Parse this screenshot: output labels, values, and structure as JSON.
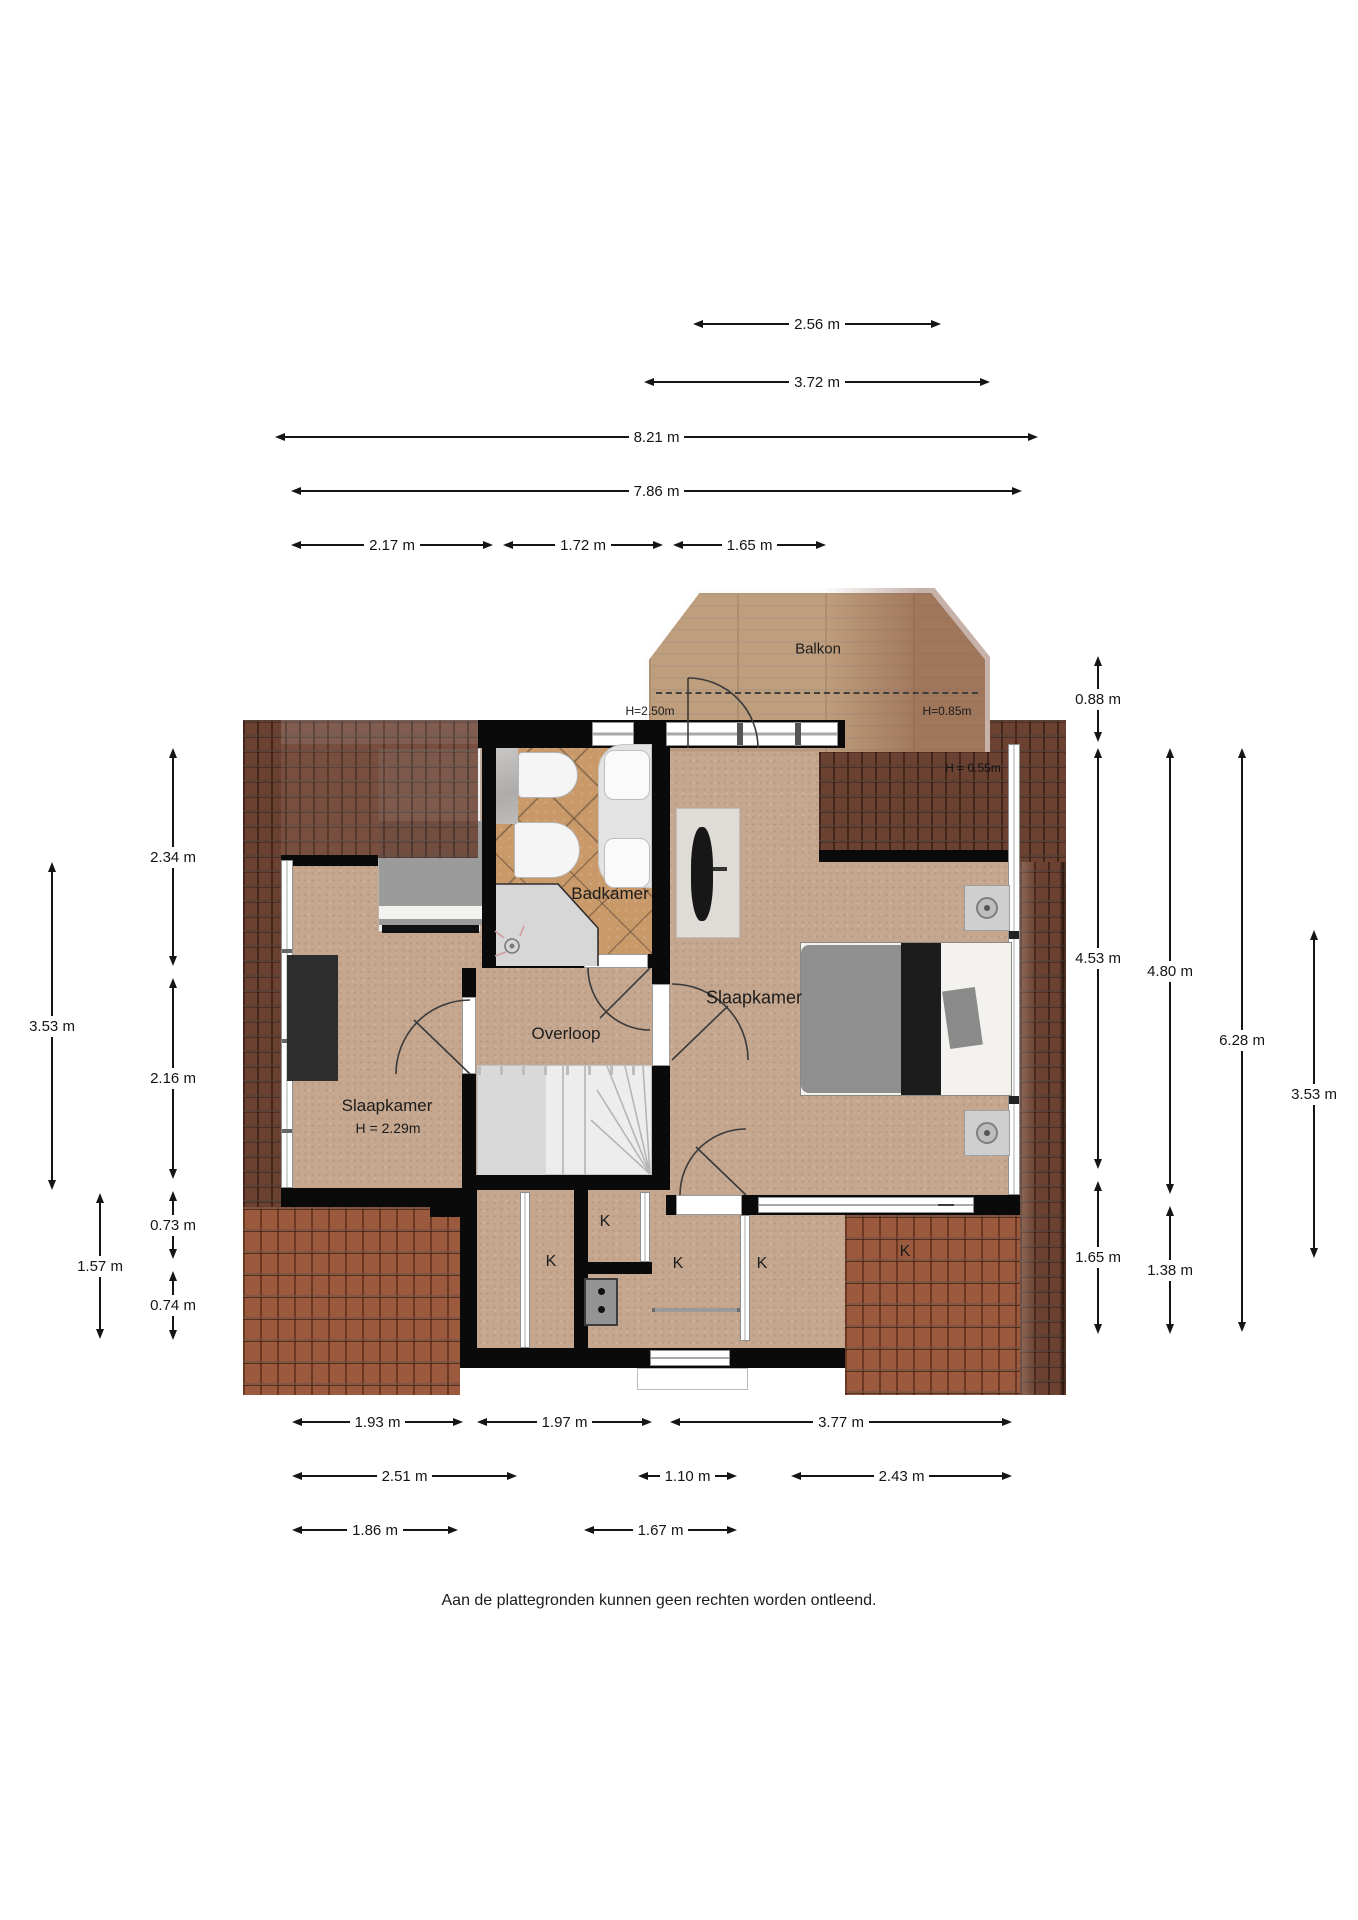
{
  "plan": {
    "balcony": "Balkon",
    "bathroom": "Badkamer",
    "landing": "Overloop",
    "bedroom_left": "Slaapkamer",
    "bedroom_left_height": "H = 2.29m",
    "bedroom_right": "Slaapkamer",
    "balcony_door_height": "H=2.50m",
    "balcony_right_height": "H=0.85m",
    "roof_right_height": "H = 0.55m",
    "closets": [
      "K",
      "K",
      "K",
      "K",
      "K"
    ],
    "disclaimer": "Aan de plattegronden kunnen geen rechten worden ontleend."
  },
  "dimensions": {
    "top": [
      "2.56 m",
      "3.72 m",
      "8.21 m",
      "7.86 m",
      "2.17 m",
      "1.72 m",
      "1.65 m"
    ],
    "left": [
      "2.34 m",
      "2.16 m",
      "0.73 m",
      "0.74 m",
      "3.53 m",
      "1.57 m"
    ],
    "right": [
      "0.88 m",
      "4.53 m",
      "1.65 m",
      "4.80 m",
      "1.38 m",
      "6.28 m",
      "3.53 m"
    ],
    "bottom": [
      "1.93 m",
      "1.97 m",
      "3.77 m",
      "2.51 m",
      "1.10 m",
      "2.43 m",
      "1.86 m",
      "1.67 m"
    ]
  },
  "colors": {
    "wall": "#0a0a0a",
    "floor": "#c5a68e",
    "bathroom_tile": "#c9996a",
    "roof_dark": "#6b4132",
    "roof_light": "#9b5a3e",
    "balcony_wood": "#bf9e7d",
    "text": "#151515"
  }
}
